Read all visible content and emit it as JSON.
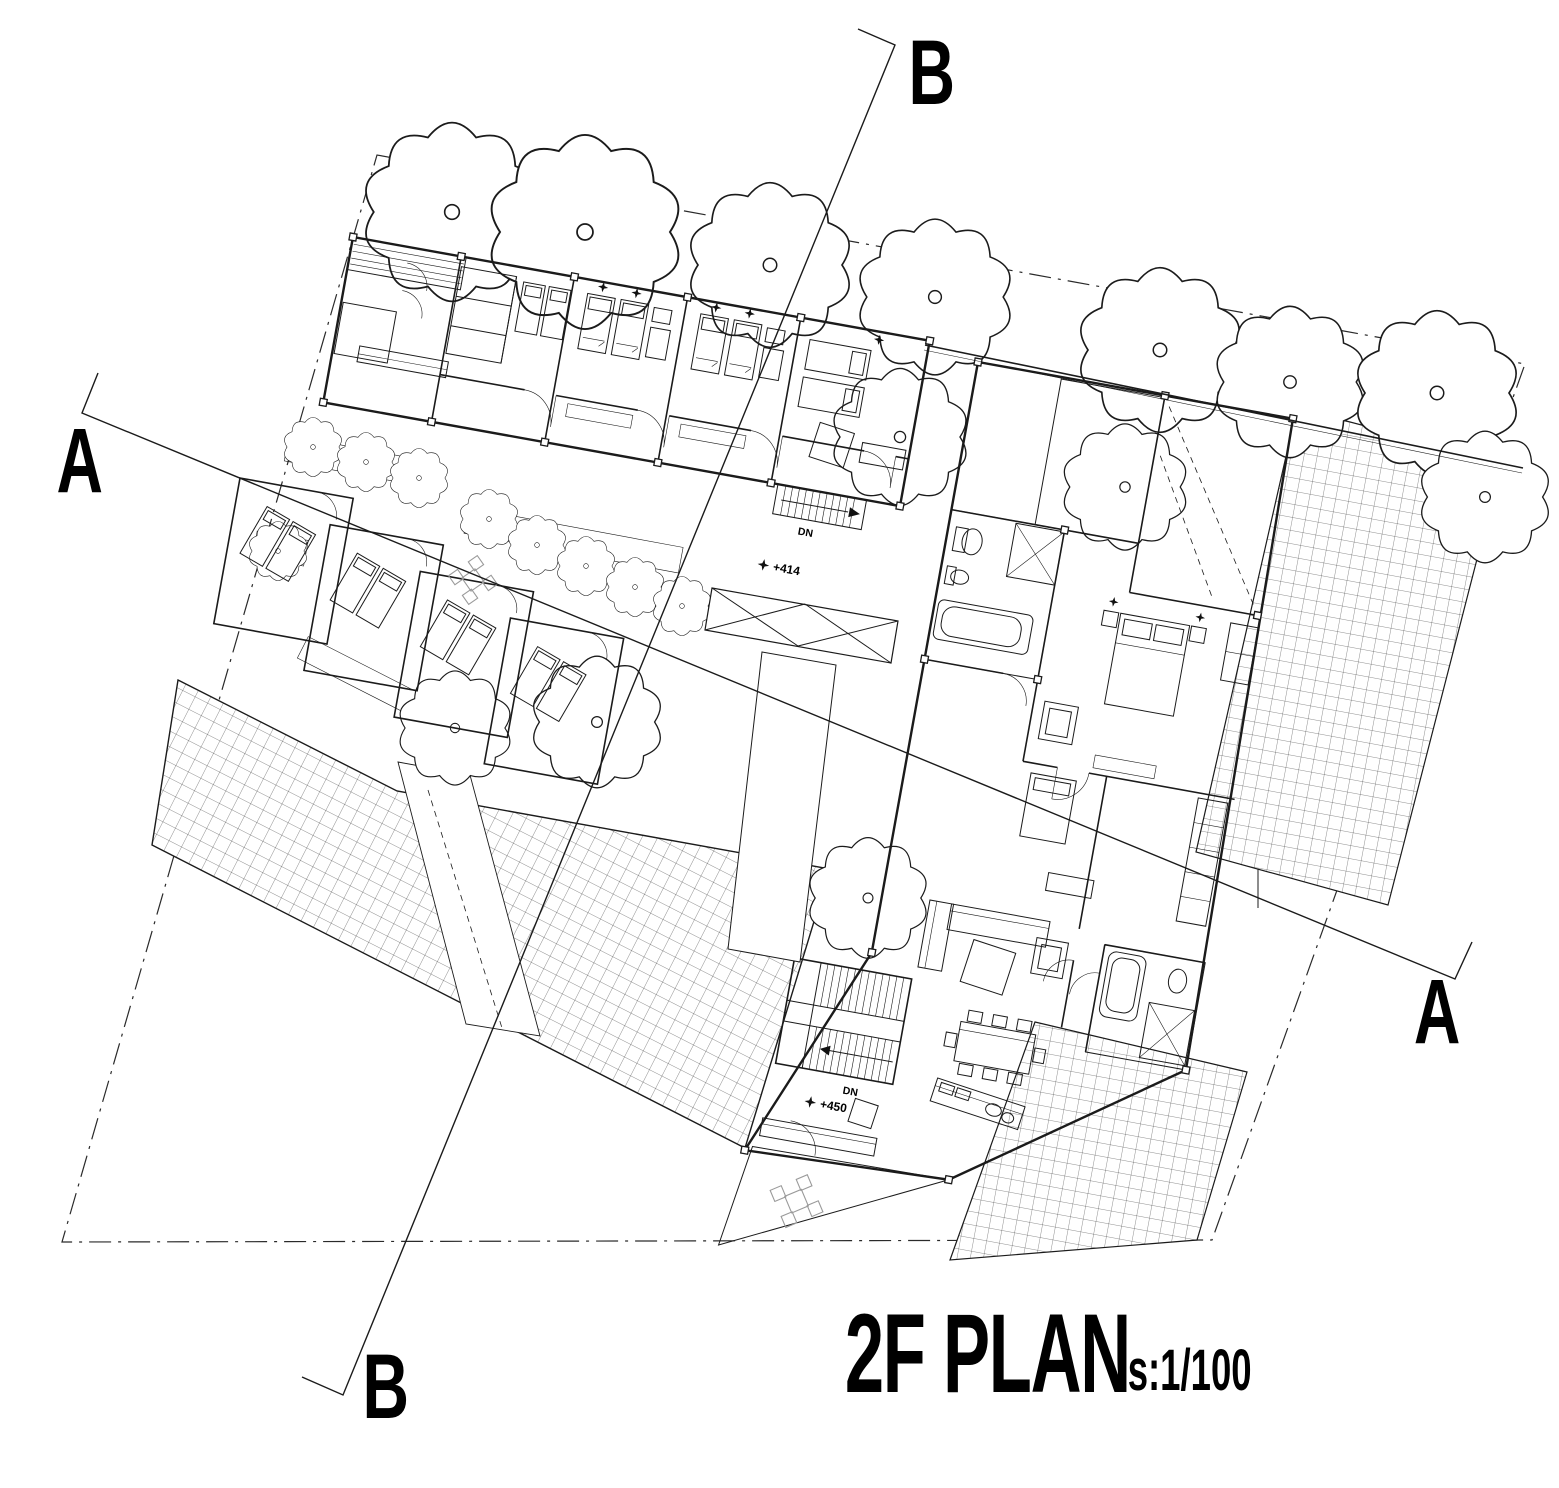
{
  "drawing": {
    "title": "2F PLAN",
    "scale_label": "s:1/100",
    "sections": {
      "top": "B",
      "bottom": "B",
      "left": "A",
      "right": "A"
    },
    "levels": {
      "upper": "+414",
      "lower": "+450"
    },
    "stairs": {
      "upper": "DN",
      "lower": "DN"
    },
    "colors": {
      "ink": "#1b1b1b",
      "bg": "#ffffff",
      "muted": "#9a9a9a"
    }
  }
}
